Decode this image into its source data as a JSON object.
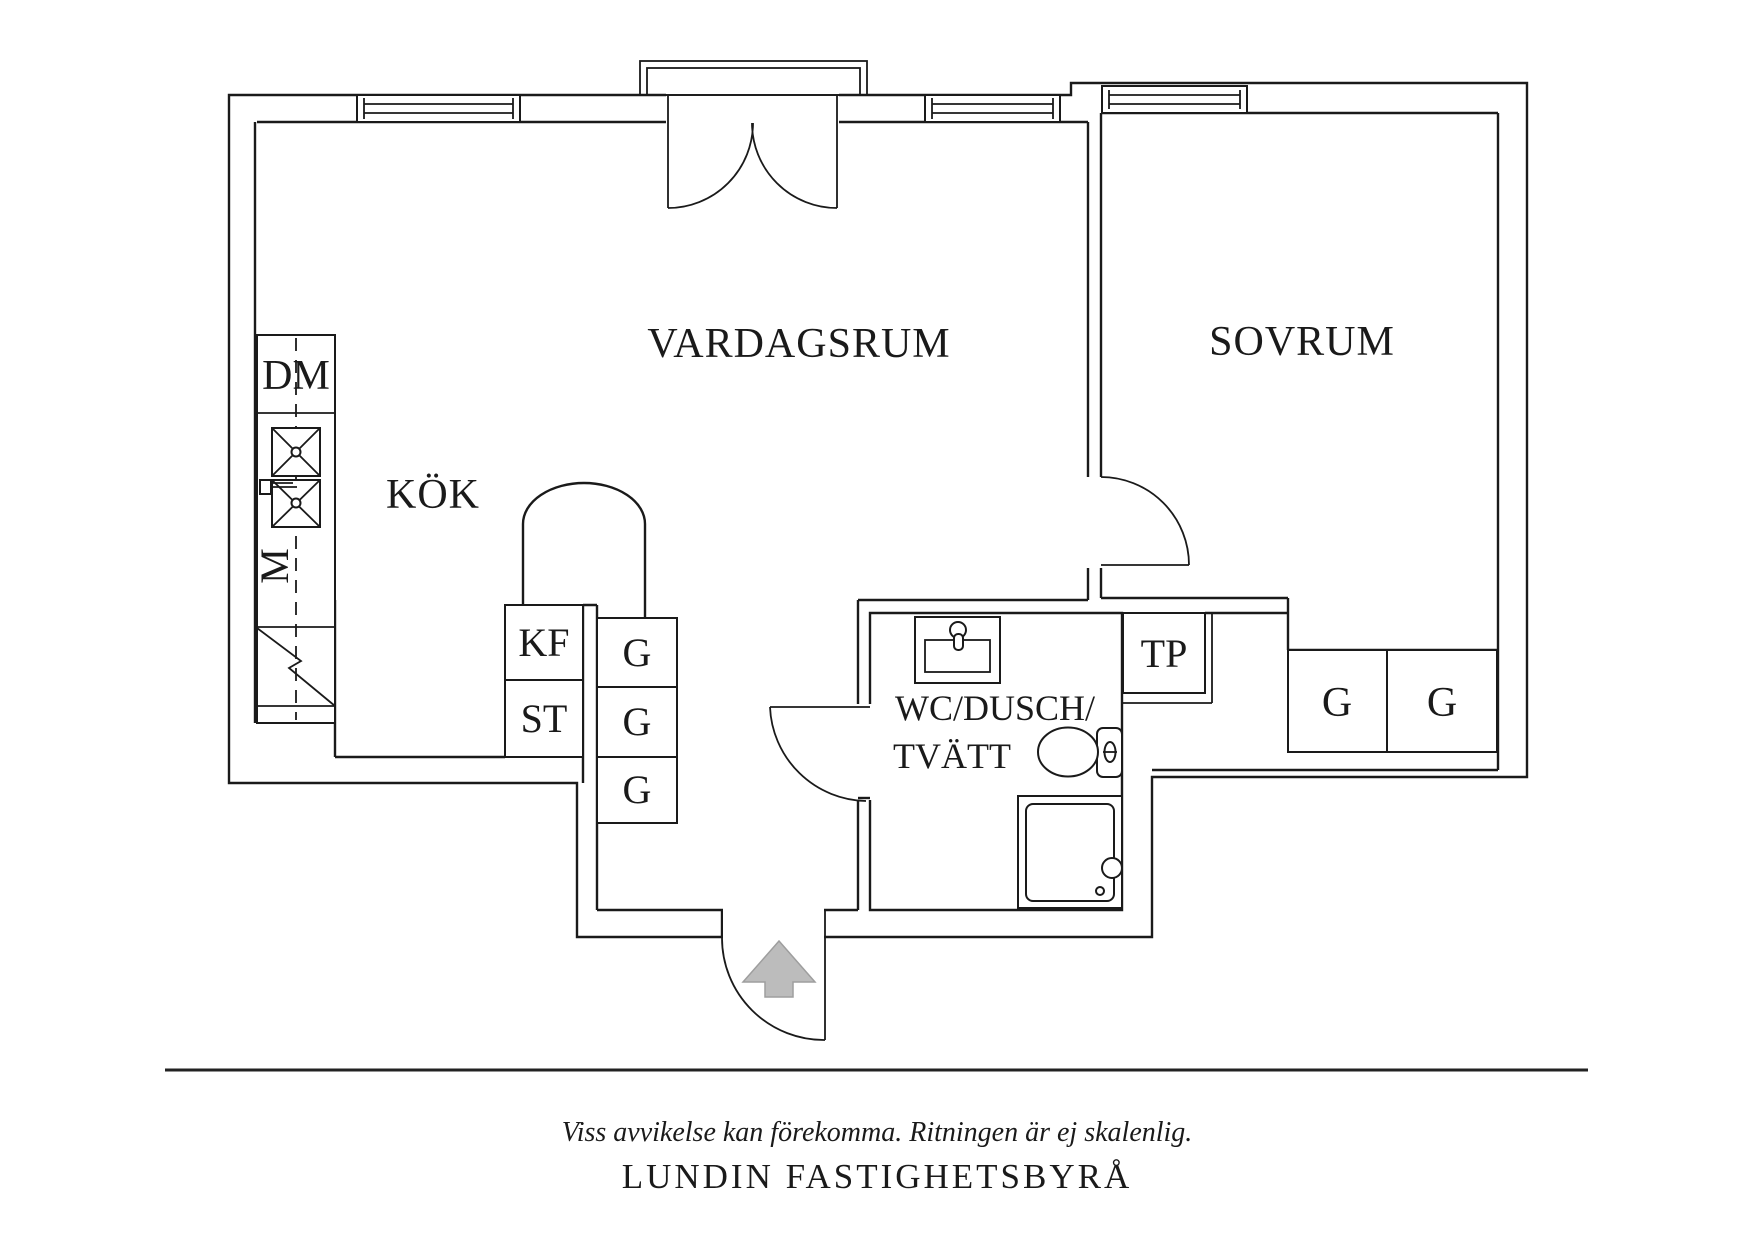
{
  "meta": {
    "document_type": "apartment floor plan"
  },
  "rooms": {
    "living_room": "VARDAGSRUM",
    "bedroom": "SOVRUM",
    "kitchen": "KÖK",
    "bathroom_line1": "WC/DUSCH/",
    "bathroom_line2": "TVÄTT"
  },
  "fixtures": {
    "dishwasher": "DM",
    "microwave": "M",
    "fridge_freezer": "KF",
    "pantry": "ST",
    "wardrobe": "G",
    "tp_cabinet": "TP"
  },
  "footer": {
    "disclaimer": "Viss avvikelse kan förekomma. Ritningen är ej skalenlig.",
    "agency": "LUNDIN FASTIGHETSBYRÅ"
  },
  "colors": {
    "line": "#1a1a1a",
    "background": "#ffffff",
    "arrow_fill": "#bcbcbc",
    "arrow_stroke": "#9e9e9e"
  }
}
